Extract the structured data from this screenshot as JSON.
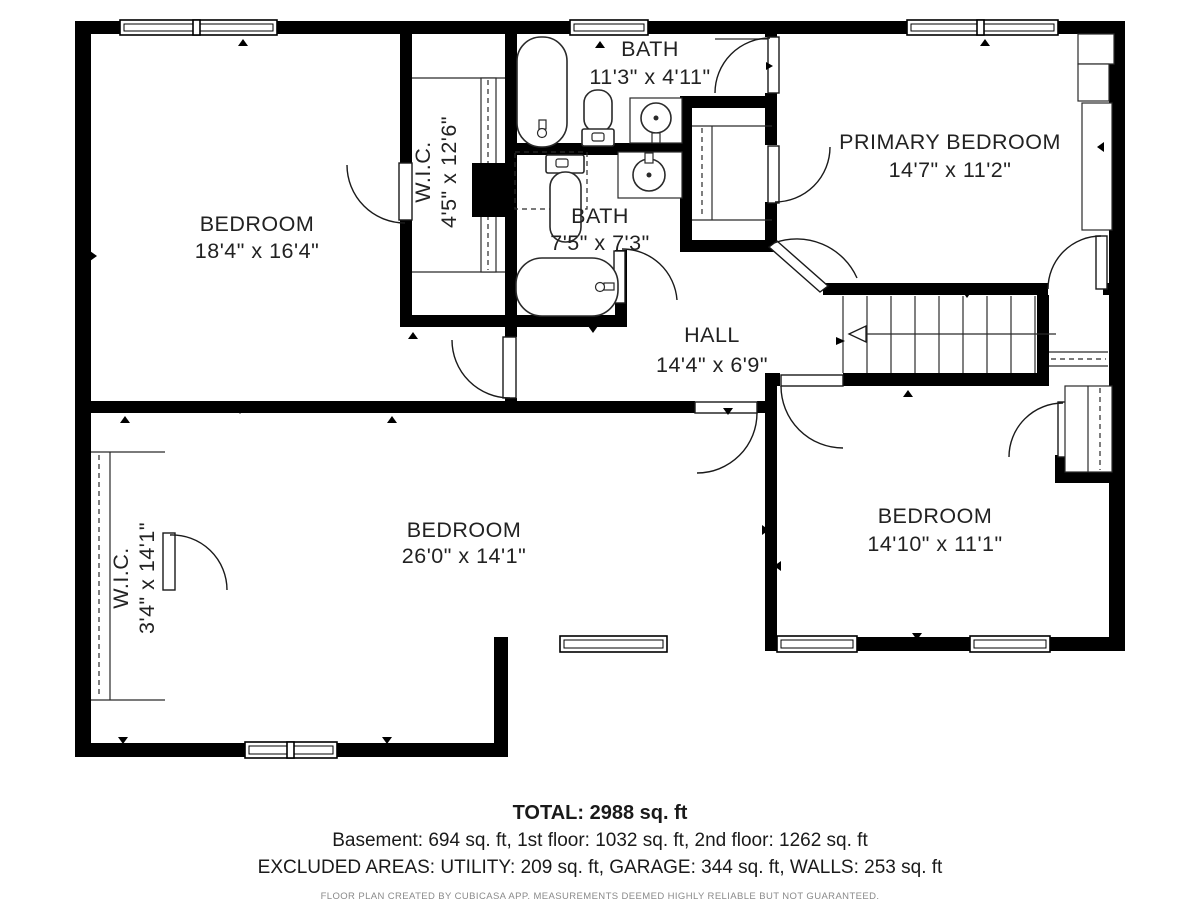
{
  "floorplan": {
    "rooms": {
      "bedroom_tl": {
        "name": "BEDROOM",
        "dims": "18'4\" x 16'4\""
      },
      "wic_top": {
        "name": "W.I.C.",
        "dims": "4'5\" x 12'6\""
      },
      "bath_top": {
        "name": "BATH",
        "dims": "11'3\" x 4'11\""
      },
      "bath_mid": {
        "name": "BATH",
        "dims": "7'5\" x 7'3\""
      },
      "primary": {
        "name": "PRIMARY BEDROOM",
        "dims": "14'7\" x 11'2\""
      },
      "hall": {
        "name": "HALL",
        "dims": "14'4\" x 6'9\""
      },
      "wic_bottom": {
        "name": "W.I.C.",
        "dims": "3'4\" x 14'1\""
      },
      "bedroom_bm": {
        "name": "BEDROOM",
        "dims": "26'0\" x 14'1\""
      },
      "bedroom_br": {
        "name": "BEDROOM",
        "dims": "14'10\" x 11'1\""
      }
    },
    "summary": {
      "total": "TOTAL: 2988 sq. ft",
      "floors": "Basement: 694 sq. ft, 1st floor: 1032 sq. ft, 2nd floor: 1262 sq. ft",
      "excluded": "EXCLUDED AREAS: UTILITY: 209 sq. ft, GARAGE: 344 sq. ft, WALLS: 253 sq. ft",
      "disclaimer": "FLOOR PLAN CREATED BY CUBICASA APP. MEASUREMENTS DEEMED HIGHLY RELIABLE BUT NOT GUARANTEED."
    },
    "colors": {
      "wall": "#000000",
      "background": "#ffffff",
      "line": "#2a2a2a",
      "disclaimer_text": "#8a8a8a"
    }
  }
}
